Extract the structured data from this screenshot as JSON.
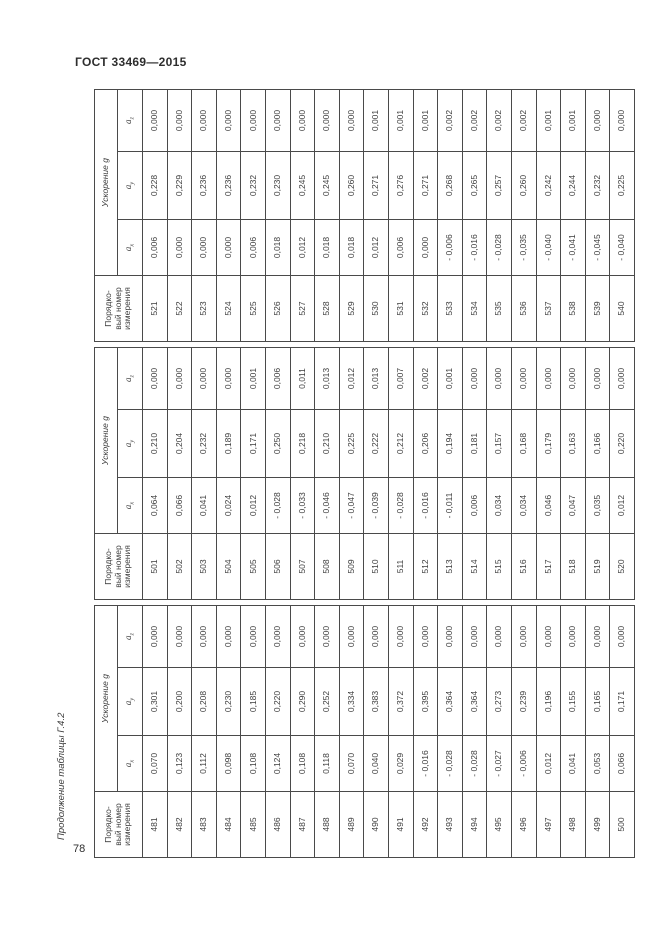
{
  "page": {
    "doc_header": "ГОСТ 33469—2015",
    "side_caption": "Продолжение таблицы Г.4.2",
    "page_number": "78"
  },
  "table": {
    "header_number": "Порядко-\nвый номер\nизмерения",
    "header_accel": "Ускорение g",
    "sub_headers": [
      {
        "sym": "a",
        "sub": "x"
      },
      {
        "sym": "a",
        "sub": "y"
      },
      {
        "sym": "a",
        "sub": "z"
      }
    ],
    "groups": [
      {
        "rows": [
          [
            "481",
            "0,070",
            "0,301",
            "0,000"
          ],
          [
            "482",
            "0,123",
            "0,200",
            "0,000"
          ],
          [
            "483",
            "0,112",
            "0,208",
            "0,000"
          ],
          [
            "484",
            "0,098",
            "0,230",
            "0,000"
          ],
          [
            "485",
            "0,108",
            "0,185",
            "0,000"
          ],
          [
            "486",
            "0,124",
            "0,220",
            "0,000"
          ],
          [
            "487",
            "0,108",
            "0,290",
            "0,000"
          ],
          [
            "488",
            "0,118",
            "0,252",
            "0,000"
          ],
          [
            "489",
            "0,070",
            "0,334",
            "0,000"
          ],
          [
            "490",
            "0,040",
            "0,383",
            "0,000"
          ],
          [
            "491",
            "0,029",
            "0,372",
            "0,000"
          ],
          [
            "492",
            "- 0,016",
            "0,395",
            "0,000"
          ],
          [
            "493",
            "- 0,028",
            "0,364",
            "0,000"
          ],
          [
            "494",
            "- 0,028",
            "0,364",
            "0,000"
          ],
          [
            "495",
            "- 0,027",
            "0,273",
            "0,000"
          ],
          [
            "496",
            "- 0,006",
            "0,239",
            "0,000"
          ],
          [
            "497",
            "0,012",
            "0,196",
            "0,000"
          ],
          [
            "498",
            "0,041",
            "0,155",
            "0,000"
          ],
          [
            "499",
            "0,053",
            "0,165",
            "0,000"
          ],
          [
            "500",
            "0,066",
            "0,171",
            "0,000"
          ]
        ]
      },
      {
        "rows": [
          [
            "501",
            "0,064",
            "0,210",
            "0,000"
          ],
          [
            "502",
            "0,066",
            "0,204",
            "0,000"
          ],
          [
            "503",
            "0,041",
            "0,232",
            "0,000"
          ],
          [
            "504",
            "0,024",
            "0,189",
            "0,000"
          ],
          [
            "505",
            "0,012",
            "0,171",
            "0,001"
          ],
          [
            "506",
            "- 0,028",
            "0,250",
            "0,006"
          ],
          [
            "507",
            "- 0,033",
            "0,218",
            "0,011"
          ],
          [
            "508",
            "- 0,046",
            "0,210",
            "0,013"
          ],
          [
            "509",
            "- 0,047",
            "0,225",
            "0,012"
          ],
          [
            "510",
            "- 0,039",
            "0,222",
            "0,013"
          ],
          [
            "511",
            "- 0,028",
            "0,212",
            "0,007"
          ],
          [
            "512",
            "- 0,016",
            "0,206",
            "0,002"
          ],
          [
            "513",
            "- 0,011",
            "0,194",
            "0,001"
          ],
          [
            "514",
            "0,006",
            "0,181",
            "0,000"
          ],
          [
            "515",
            "0,034",
            "0,157",
            "0,000"
          ],
          [
            "516",
            "0,034",
            "0,168",
            "0,000"
          ],
          [
            "517",
            "0,046",
            "0,179",
            "0,000"
          ],
          [
            "518",
            "0,047",
            "0,163",
            "0,000"
          ],
          [
            "519",
            "0,035",
            "0,166",
            "0,000"
          ],
          [
            "520",
            "0,012",
            "0,220",
            "0,000"
          ]
        ]
      },
      {
        "rows": [
          [
            "521",
            "0,006",
            "0,228",
            "0,000"
          ],
          [
            "522",
            "0,000",
            "0,229",
            "0,000"
          ],
          [
            "523",
            "0,000",
            "0,236",
            "0,000"
          ],
          [
            "524",
            "0,000",
            "0,236",
            "0,000"
          ],
          [
            "525",
            "0,006",
            "0,232",
            "0,000"
          ],
          [
            "526",
            "0,018",
            "0,230",
            "0,000"
          ],
          [
            "527",
            "0,012",
            "0,245",
            "0,000"
          ],
          [
            "528",
            "0,018",
            "0,245",
            "0,000"
          ],
          [
            "529",
            "0,018",
            "0,260",
            "0,000"
          ],
          [
            "530",
            "0,012",
            "0,271",
            "0,001"
          ],
          [
            "531",
            "0,006",
            "0,276",
            "0,001"
          ],
          [
            "532",
            "0,000",
            "0,271",
            "0,001"
          ],
          [
            "533",
            "- 0,006",
            "0,268",
            "0,002"
          ],
          [
            "534",
            "- 0,016",
            "0,265",
            "0,002"
          ],
          [
            "535",
            "- 0,028",
            "0,257",
            "0,002"
          ],
          [
            "536",
            "- 0,035",
            "0,260",
            "0,002"
          ],
          [
            "537",
            "- 0,040",
            "0,242",
            "0,001"
          ],
          [
            "538",
            "- 0,041",
            "0,244",
            "0,001"
          ],
          [
            "539",
            "- 0,045",
            "0,232",
            "0,000"
          ],
          [
            "540",
            "- 0,040",
            "0,225",
            "0,000"
          ]
        ]
      }
    ]
  }
}
